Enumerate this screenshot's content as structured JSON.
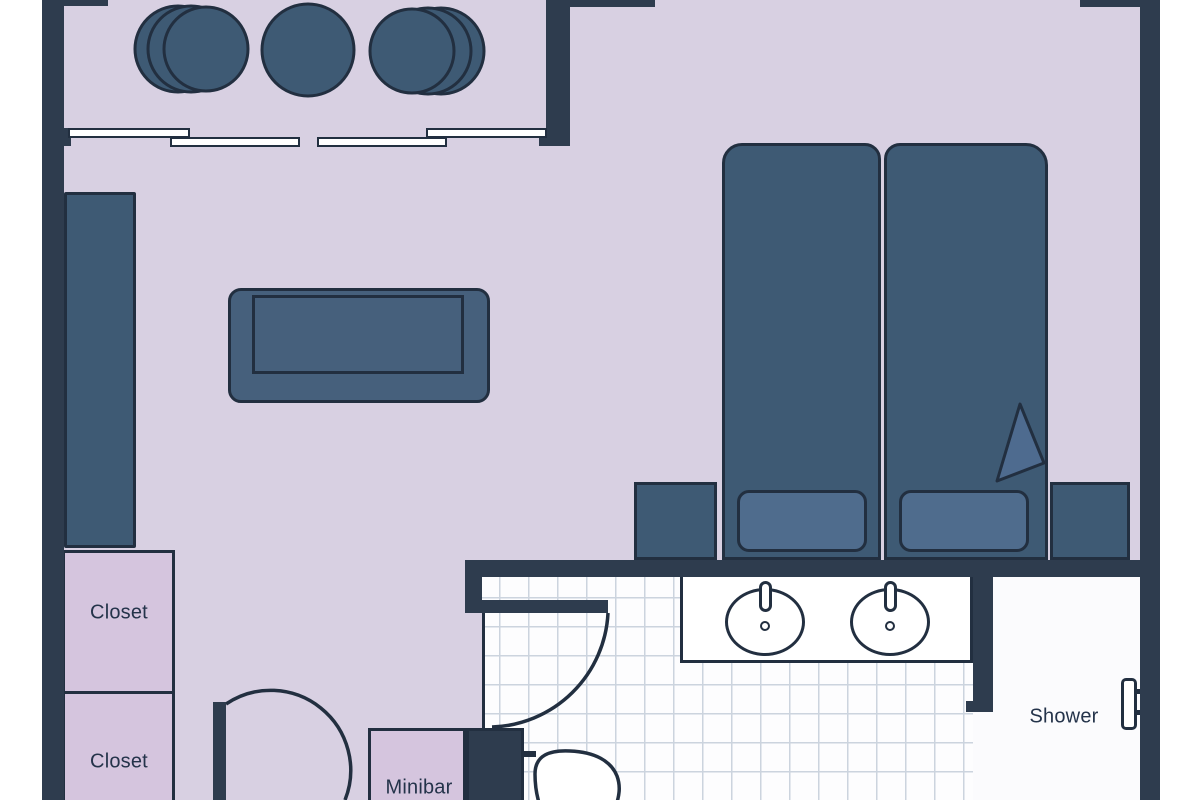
{
  "title": "Hotel room floor plan",
  "labels": {
    "closet_upper": "Closet",
    "closet_lower": "Closet",
    "minibar": "Minibar",
    "shower": "Shower"
  },
  "palette": {
    "wall": "#2e3c4e",
    "outline": "#222f40",
    "floor": "#d8d0e2",
    "furniture": "#3e5a74",
    "furniture_mid": "#46607c",
    "pillow": "#4f6c8d",
    "fold": "#4e6b8f",
    "closet": "#d5c5de",
    "tile_bg": "#fdfdfe",
    "tile_line": "#ccd4de",
    "shower_bg": "#fbfbfd",
    "white": "#ffffff",
    "label": "#24334a"
  }
}
